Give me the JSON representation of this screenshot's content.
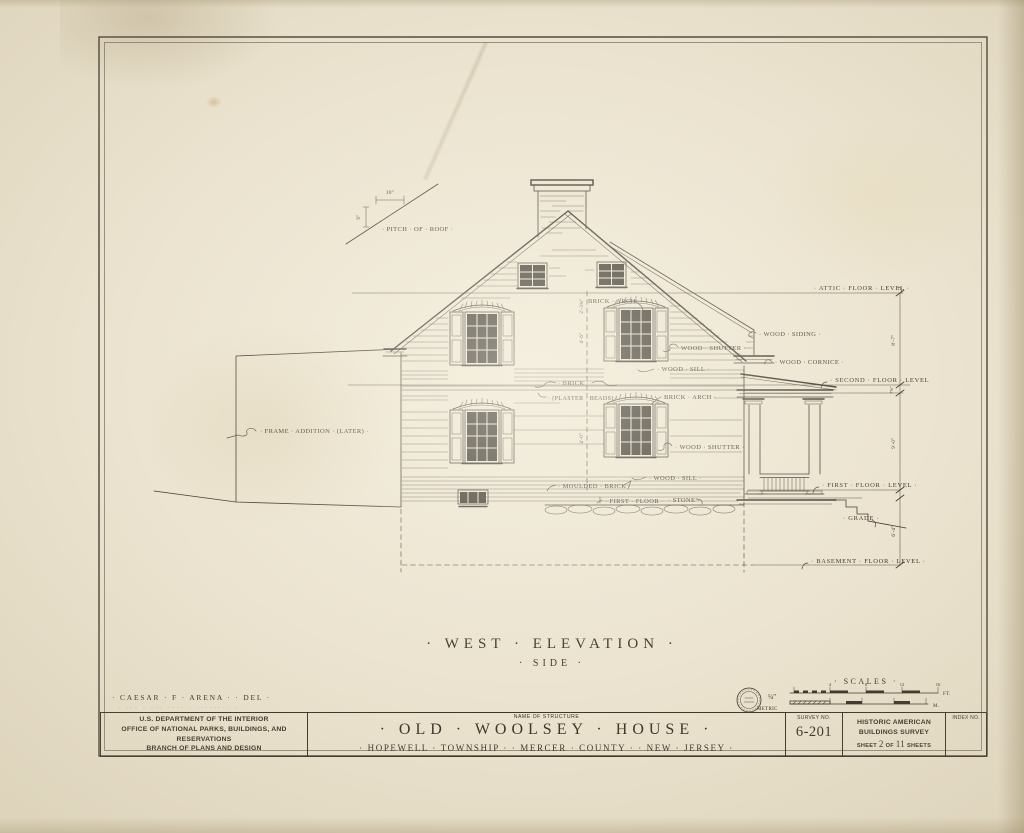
{
  "colors": {
    "paper": "#ebe3cf",
    "ink": "#3a342a",
    "faded": "#c3b493"
  },
  "caption": {
    "title": "· WEST · ELEVATION ·",
    "subtitle": "· SIDE ·"
  },
  "credit": {
    "line1": "· CAESAR · F · ARENA · · DEL ·",
    "line2_erased": "· ··· · ··· ···· · ········ ·"
  },
  "scales": {
    "title": "· SCALES ·",
    "imperial_label": "¼\"",
    "metric_label": "METRIC",
    "imperial_unit": "FT.",
    "metric_unit": "M.",
    "tick_4": "4",
    "tick_8": "8",
    "tick_12": "12",
    "tick_16": "16"
  },
  "levels": {
    "attic": "· ATTIC · FLOOR · LEVEL ·",
    "second": "· SECOND · FLOOR · LEVEL",
    "first": "· FIRST · FLOOR · LEVEL ·",
    "basement": "· BASEMENT · FLOOR · LEVEL ·",
    "grade": "· GRADE ·"
  },
  "dims": {
    "attic_to_second": "8'-7\"",
    "second_offset": "7⅝\"",
    "second_to_first": "9'-0\"",
    "first_to_basement": "6'-4\"",
    "pitch_run": "10\"",
    "pitch_rise": "9\"",
    "win_upper": "2'-3¾\"",
    "win_mid": "4'-6\"",
    "win_lower": "4'-0\""
  },
  "annotations": {
    "pitch_of_roof": "· PITCH · OF · ROOF ·",
    "frame_addition": "· FRAME · ADDITION · (LATER) ·",
    "brick_arch_upper": "BRICK · ARCH",
    "wood_shutter_upper": "WOOD · SHUTTER ·",
    "wood_sill_upper": "· WOOD · SILL ·",
    "wood_siding": "· WOOD · SIDING ·",
    "wood_cornice": "· WOOD · CORNICE ·",
    "brick": "· BRICK ·",
    "plaster_beads": "· (PLASTER · BEADS) ·",
    "brick_arch_lower": "BRICK · ARCH ·",
    "wood_shutter_lower": "· WOOD · SHUTTER ·",
    "wood_sill_lower": "· WOOD · SILL ·",
    "moulded_brick": "· MOULDED · BRICK ·",
    "first_floor": "· FIRST · FLOOR ·",
    "stone": "· STONE ·"
  },
  "title_block": {
    "agency_line1": "U.S. DEPARTMENT OF THE INTERIOR",
    "agency_line2": "OFFICE OF NATIONAL PARKS, BUILDINGS, AND RESERVATIONS",
    "agency_line3": "BRANCH OF PLANS AND DESIGN",
    "name_of_structure_label": "NAME OF STRUCTURE",
    "structure_name": "· OLD · WOOLSEY · HOUSE ·",
    "structure_location": "· HOPEWELL · TOWNSHIP ·  · MERCER · COUNTY ·  · NEW · JERSEY ·",
    "survey_label": "SURVEY NO.",
    "survey_no": "6-201",
    "habs_line1": "HISTORIC AMERICAN",
    "habs_line2": "BUILDINGS SURVEY",
    "sheet_prefix": "SHEET",
    "sheet_no": "2",
    "sheet_of": "OF",
    "sheet_total": "11",
    "sheet_suffix": "SHEETS",
    "index_label": "INDEX NO."
  }
}
